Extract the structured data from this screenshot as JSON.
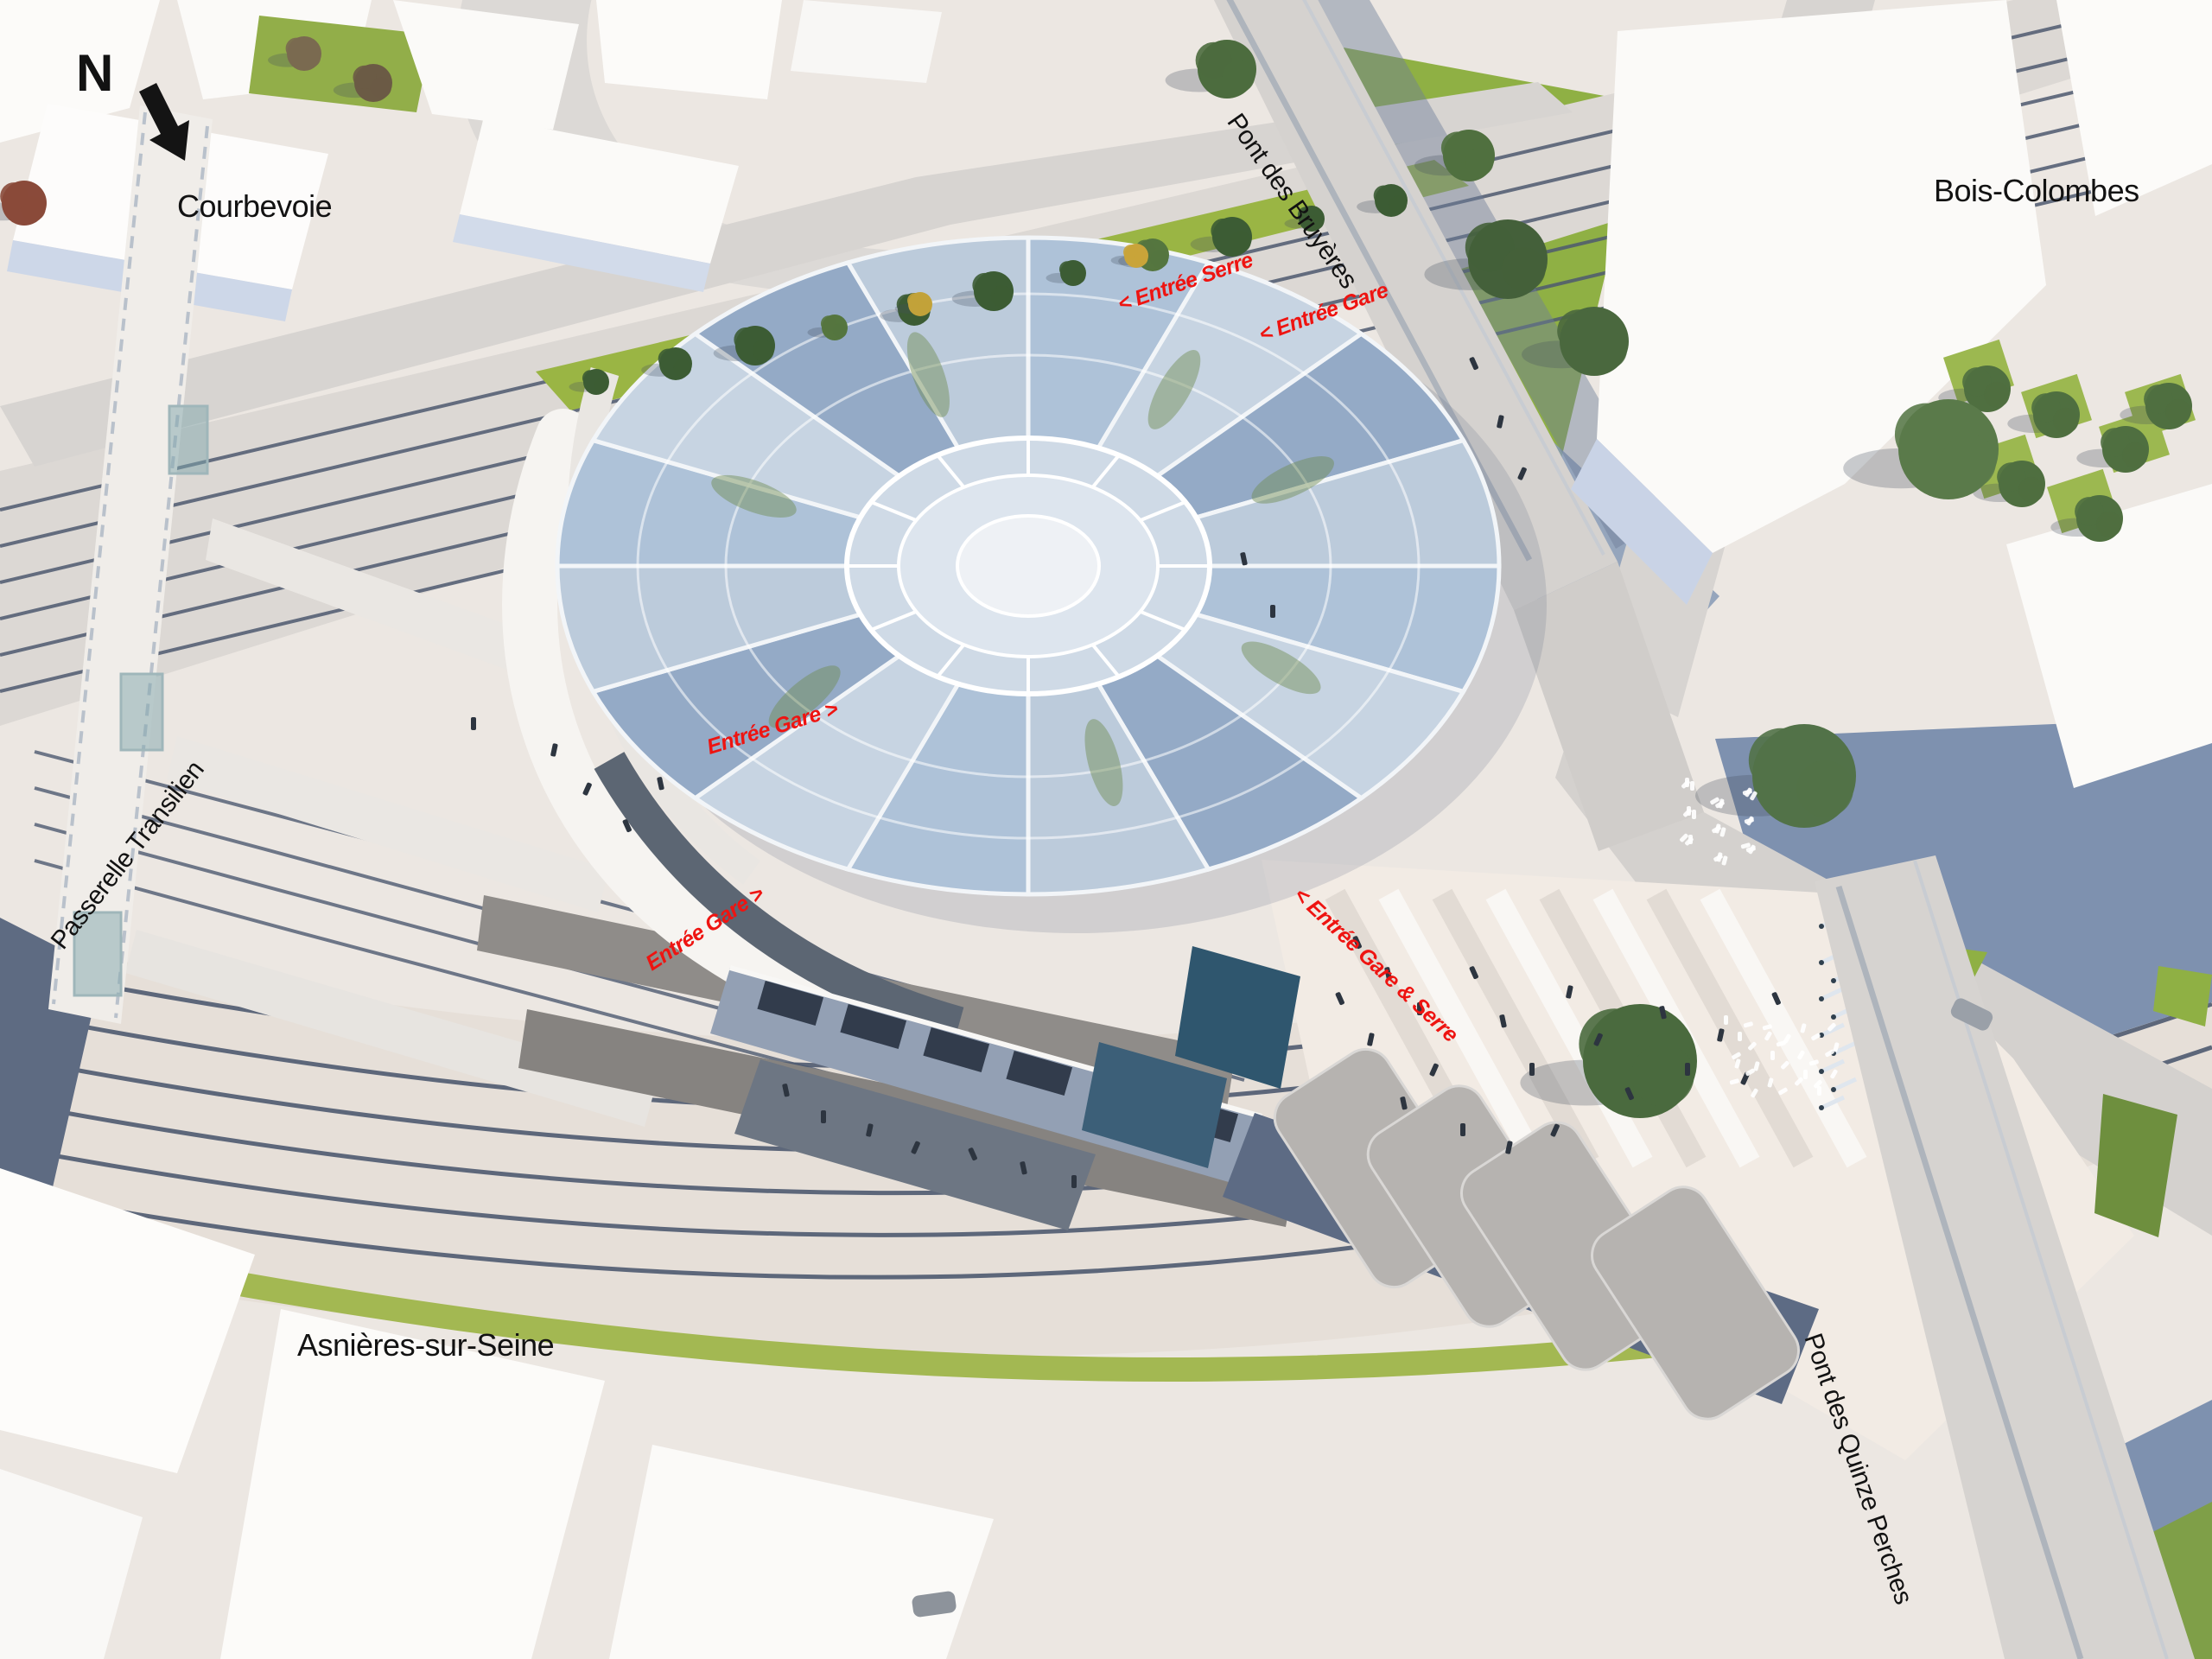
{
  "compass": {
    "north_letter": "N"
  },
  "districts": {
    "courbevoie": "Courbevoie",
    "bois_colombes": "Bois-Colombes",
    "asnieres": "Asnières-sur-Seine"
  },
  "structures": {
    "pont_des_bruyeres": "Pont des Bruyères",
    "pont_des_quinze_perches": "Pont des Quinze Perches",
    "passerelle_transilien": "Passerelle Transilien"
  },
  "entrances": {
    "entree_serre": "< Entrée Serre",
    "entree_gare_nord": "< Entrée Gare",
    "entree_gare_ouest": "Entrée Gare >",
    "entree_gare_sud": "Entrée Gare >",
    "entree_gare_et_serre": "< Entrée Gare & Serre"
  },
  "colors": {
    "annotation_red": "#ee1411",
    "label_black": "#121212",
    "glass_blue": "#aec2d8",
    "glass_blue_dark": "#94aac6",
    "glass_blue_light": "#c7d4e2",
    "lawn_green": "#8fb044",
    "median_green": "#9ab544",
    "track_slate": "#4e5a70",
    "shadow_slate": "#7e91af",
    "road_grey": "#d6d3d0",
    "building_white": "#fcfbf9",
    "building_face": "#cbd5e7",
    "dark_wall": "#5c6673",
    "viaduct_dark": "#5d6b84"
  }
}
